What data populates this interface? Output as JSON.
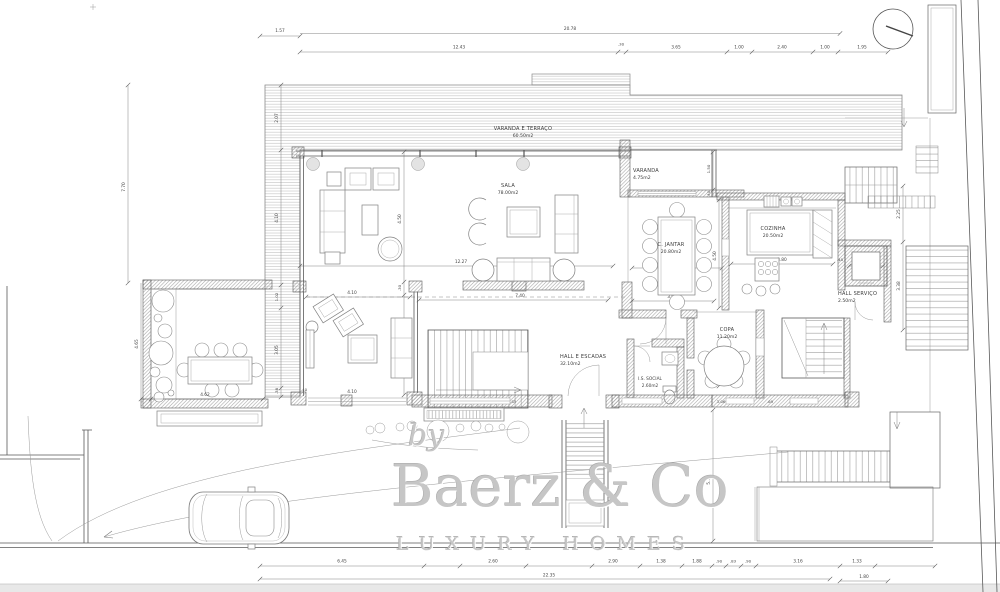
{
  "watermark": {
    "by": "by",
    "brand": "Baerz & Co",
    "tagline": "LUXURY HOMES"
  },
  "rooms": {
    "varanda_terraco": {
      "label": "VARANDA E TERRAÇO",
      "area": "60.50m2"
    },
    "sala": {
      "label": "SALA",
      "area": "78.00m2"
    },
    "varanda": {
      "label": "VARANDA",
      "area": "4.75m2"
    },
    "c_jantar": {
      "label": "C. JANTAR",
      "area": "20.80m2"
    },
    "cozinha": {
      "label": "COZINHA",
      "area": "20.50m2"
    },
    "hall_servico": {
      "label": "HALL SERVIÇO",
      "area": "2.50m2"
    },
    "hall_escadas": {
      "label": "HALL E ESCADAS",
      "area": "32.10m2"
    },
    "is_social": {
      "label": "I.S. SOCIAL",
      "area": "2.60m2"
    },
    "copa": {
      "label": "COPA",
      "area": "11.20m2"
    }
  },
  "dims": {
    "top1": "1.57",
    "top2": "20.78",
    "r2": [
      "12.43",
      ".30",
      "3.65",
      "1.00",
      "2.40",
      "1.00",
      "1.95"
    ],
    "l1": "7.70",
    "l2": "4.65",
    "lc": [
      "2.07",
      "4.10",
      "1.02",
      "3.05",
      ".38"
    ],
    "sala_w": "12.27",
    "hall_w": "7.40",
    "sc": [
      "4.50",
      ".30",
      "4.55"
    ],
    "tv1": "4.10",
    "tv2": "4.10",
    "ter": "4.62",
    "ter2": ".40",
    "dj_w": "4.00",
    "dj_b": "3.85",
    "dj_h": "4.50",
    "var_h": "1.50",
    "var_g": ".40",
    "kit_w": "3.80",
    "kit_g": ".40",
    "elev": "1.65",
    "re1": "2.25",
    "re2": "3.38",
    "copa_h": "3.20",
    "ent_h": "5.15",
    "hb": [
      "3.85",
      ".65",
      "1.32",
      "3.06",
      ".69",
      "1.95"
    ],
    "b1": [
      "6.45",
      "2.60",
      "2.90",
      "1.38",
      "1.88",
      ".90",
      ".83",
      ".90",
      "3.16",
      "1.33"
    ],
    "b2": "22.35",
    "b3": "1.80"
  }
}
